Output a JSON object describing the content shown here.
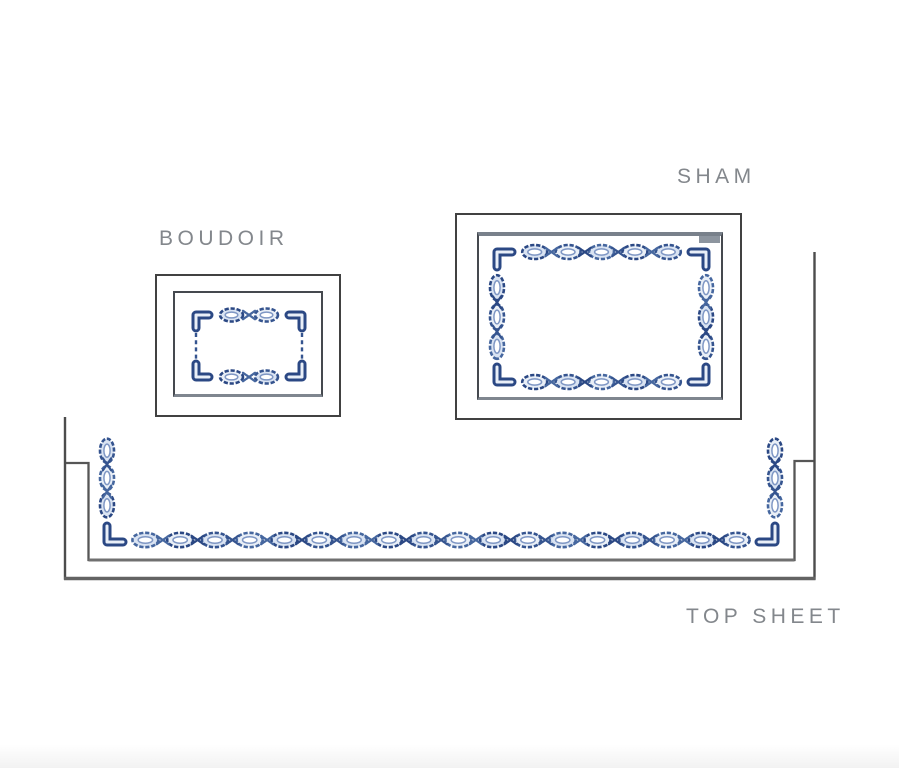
{
  "labels": {
    "boudoir": "BOUDOIR",
    "sham": "SHAM",
    "top_sheet": "TOP SHEET"
  },
  "colors": {
    "background": "#ffffff",
    "label_text": "#83878c",
    "box_outline": "#414141",
    "inner_outline": "#45494f",
    "sheet_line": "#4c4c4c",
    "sheet_line_thick": "#636363",
    "chain_stroke": "#35548f",
    "chain_dark": "#2b4884",
    "chain_light_stroke": "#46679f",
    "chain_mid": "#7f97c4",
    "chain_fill": "#d9e3f2",
    "chain_fill_alt": "#e9eff7",
    "tab_gray": "#8d959f"
  }
}
